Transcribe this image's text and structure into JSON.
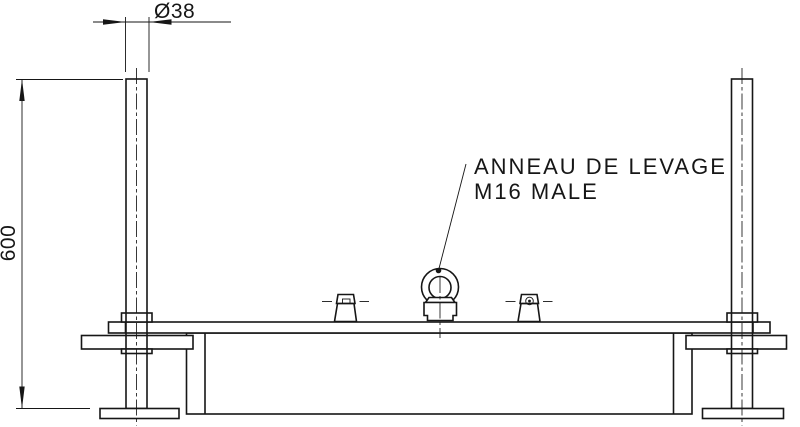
{
  "drawing": {
    "background_color": "#ffffff",
    "line_color": "#161616",
    "labels": {
      "lifting_ring_line1": "ANNEAU DE LEVAGE",
      "lifting_ring_line2": "M16 MALE"
    },
    "dimensions": {
      "post_diameter": "Ø38",
      "post_height": "600"
    }
  }
}
